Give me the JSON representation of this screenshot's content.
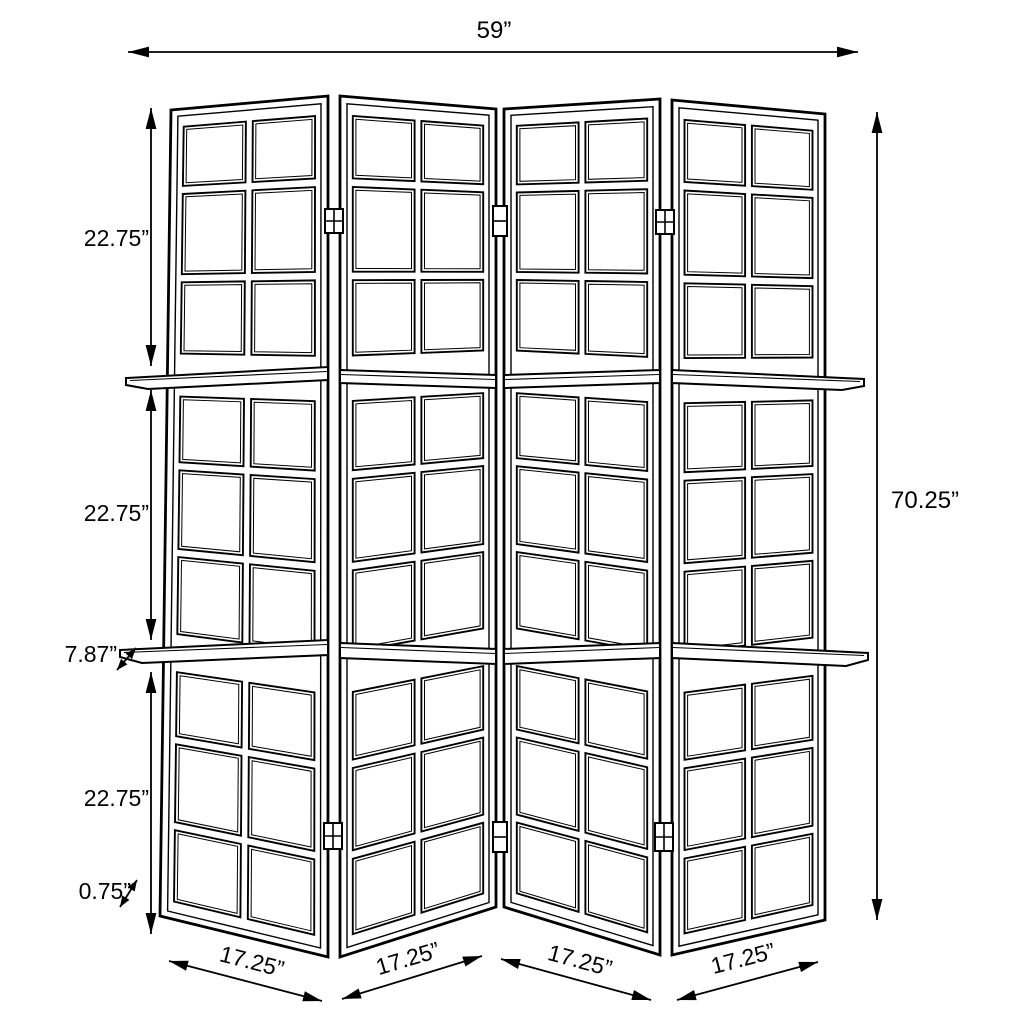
{
  "diagram": {
    "background_color": "#ffffff",
    "line_color": "#000000",
    "labels": {
      "overall_width": "59”",
      "overall_height": "70.25”",
      "section_heights": [
        "22.75”",
        "22.75”",
        "22.75”"
      ],
      "shelf_depth": "7.87”",
      "bottom_frame": "0.75”",
      "panel_widths": [
        "17.25”",
        "17.25”",
        "17.25”",
        "17.25”"
      ]
    }
  }
}
